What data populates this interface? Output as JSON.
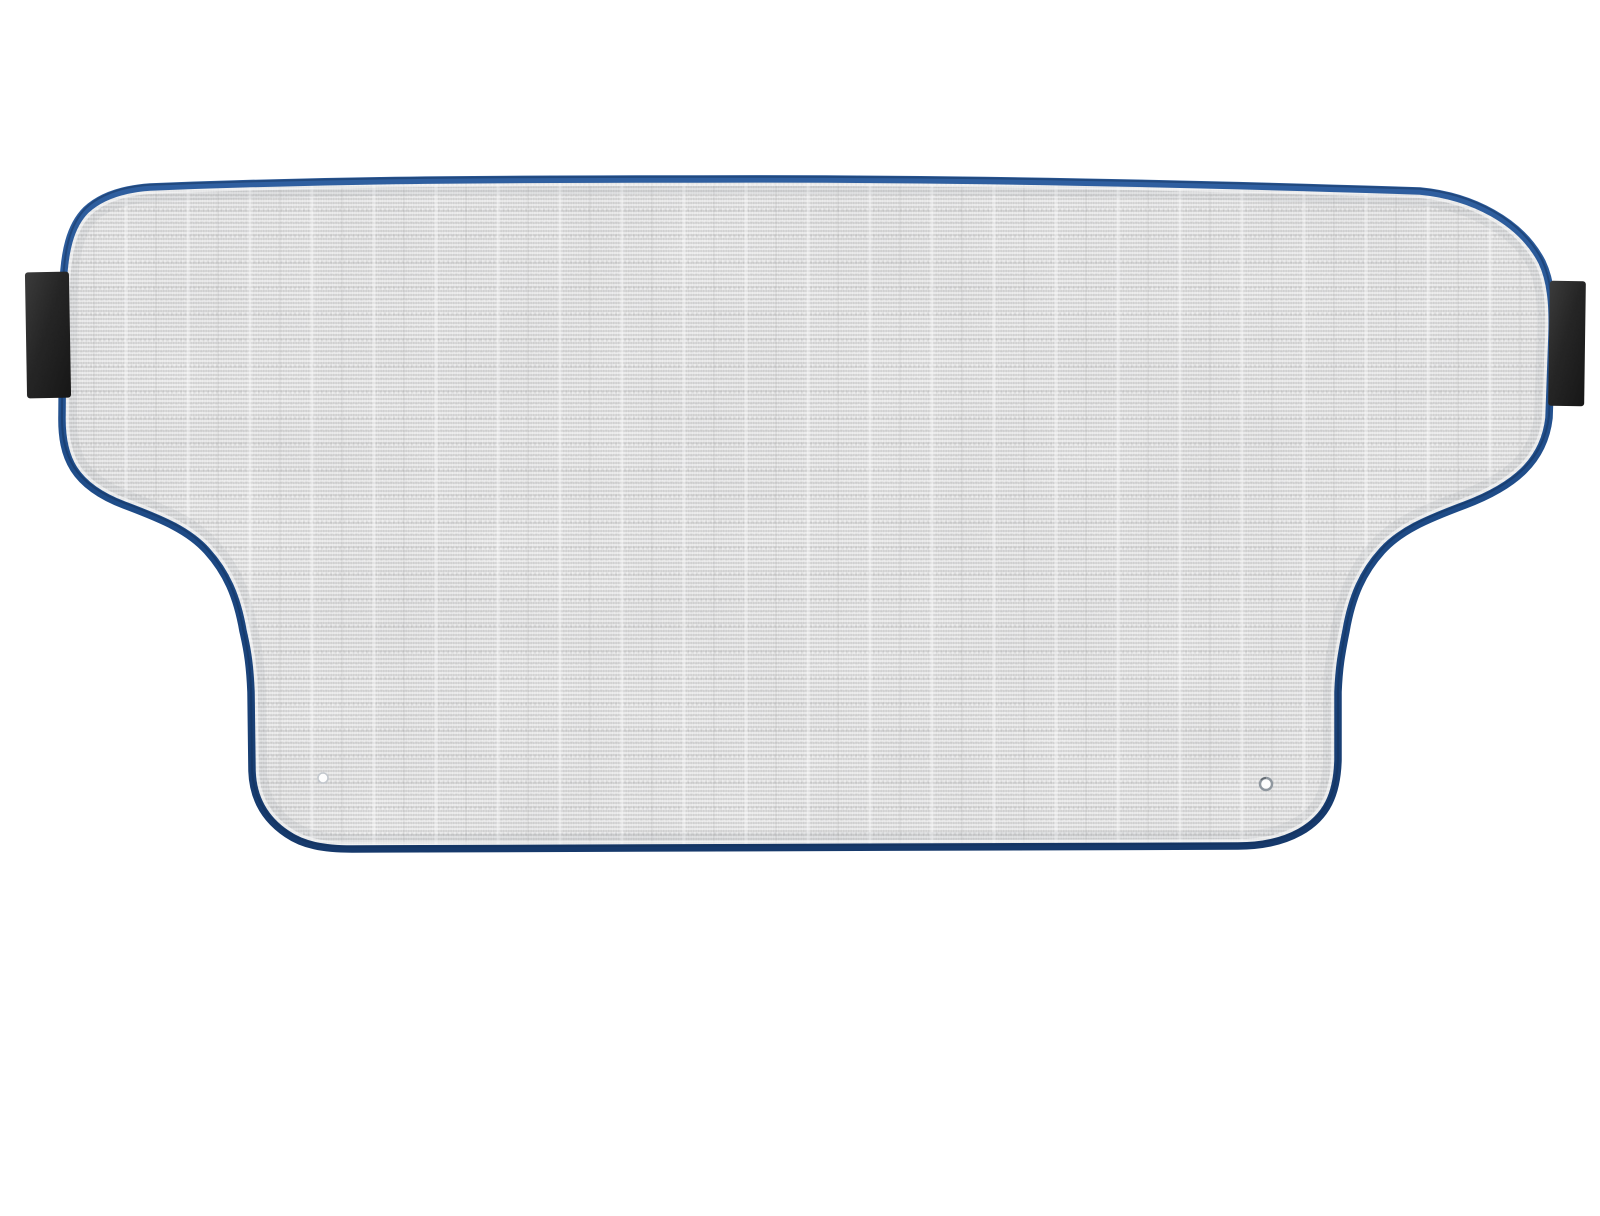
{
  "meta": {
    "scene": "product-photo",
    "description": "Car windshield snow and sun cover shade lying flat on a plain white background",
    "canvas_width": 1600,
    "canvas_height": 1216
  },
  "background": {
    "color": "#ffffff"
  },
  "cover": {
    "fabric": {
      "base_color": "#ececec",
      "rib_color": "#d9d9d9",
      "highlight_line_color": "#f9f9f9",
      "shadow_line_color": "#d0d0d0",
      "stitch_dash_color": "#8f8f8f",
      "column_highlight_color": "#ffffff",
      "inner_edge_highlight": "#ffffff"
    },
    "trim": {
      "top_color": "#2f5fa0",
      "mid_color": "#1e4b87",
      "bottom_color": "#16396b"
    },
    "straps": {
      "count": 2,
      "sides": [
        "left",
        "right"
      ],
      "light_color": "#3c3c3c",
      "mid_color": "#262626",
      "dark_color": "#161616"
    },
    "grommets": {
      "count": 2,
      "center_color": "#fdfdfd",
      "ring_color": "#8f979f",
      "left_ring_color": "#c3c8ce"
    }
  }
}
